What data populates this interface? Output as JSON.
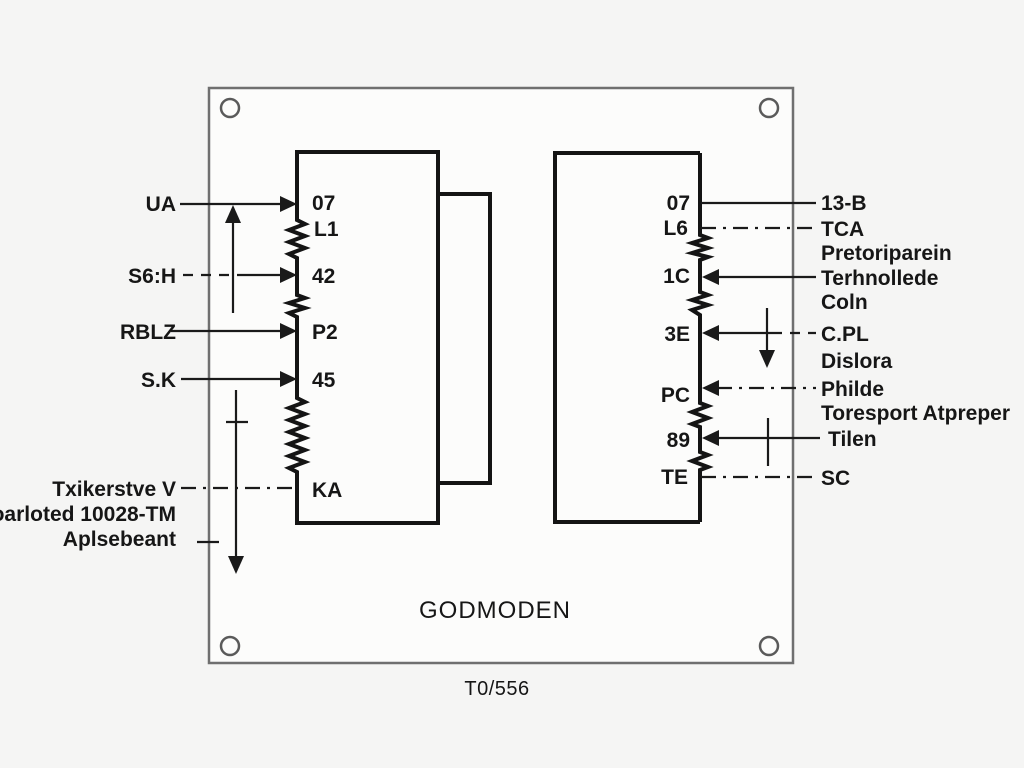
{
  "diagram": {
    "title": "GODMODEN",
    "code": "T0/556",
    "left_block": {
      "pins": {
        "p07": "07",
        "l1": "L1",
        "p42": "42",
        "p2": "P2",
        "p45": "45",
        "ka": "KA"
      }
    },
    "right_block": {
      "pins": {
        "p07": "07",
        "l6": "L6",
        "c1": "1C",
        "e3": "3E",
        "pc": "PC",
        "p89": "89",
        "te": "TE"
      }
    },
    "left_annotations": {
      "ua": "UA",
      "s6h": "S6:H",
      "rblz": "RBLZ",
      "sk": "S.K",
      "note1": "Txikerstve V",
      "note2": "Foarloted 10028-TM",
      "note3": "Aplsebeant"
    },
    "right_annotations": {
      "a1": "13-B",
      "a2": "TCA",
      "a3": "Pretoriparein",
      "a4": "Terhnollede",
      "a5": "Coln",
      "a6": "C.PL",
      "a7": "Dislora",
      "a8": "Philde",
      "a9": "Toresport Atpreper",
      "a10": "Tilen",
      "a11": "SC"
    }
  },
  "colors": {
    "line": "#1a1a1a",
    "panel_border": "#6f6f6f",
    "background": "#f5f5f4"
  }
}
